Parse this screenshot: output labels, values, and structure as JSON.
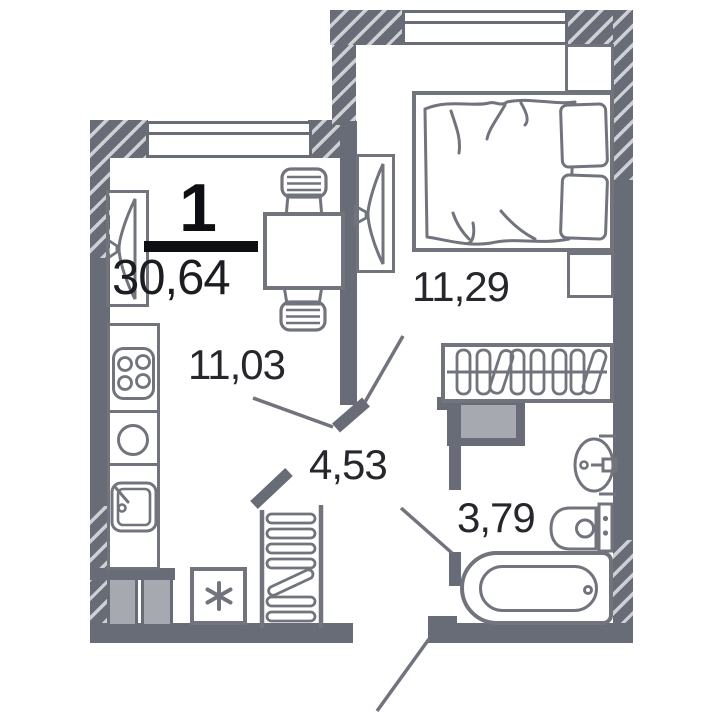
{
  "plan": {
    "title_block": {
      "rooms_count": "1",
      "total_area": "30,64"
    },
    "rooms": [
      {
        "name": "kitchen-living-room",
        "area": "11,03"
      },
      {
        "name": "bedroom",
        "area": "11,29"
      },
      {
        "name": "hallway",
        "area": "4,53"
      },
      {
        "name": "bathroom",
        "area": "3,79"
      }
    ],
    "icons": {
      "washing_machine_mark": "✳"
    },
    "colors": {
      "wall": "#686c76",
      "furniture_line": "#71747d",
      "light_fill": "#a7a9b0",
      "hatch_stripe": "#cfd0d4",
      "label_text": "#26272c",
      "accent_black": "#0e0f12",
      "background": "#ffffff"
    }
  }
}
